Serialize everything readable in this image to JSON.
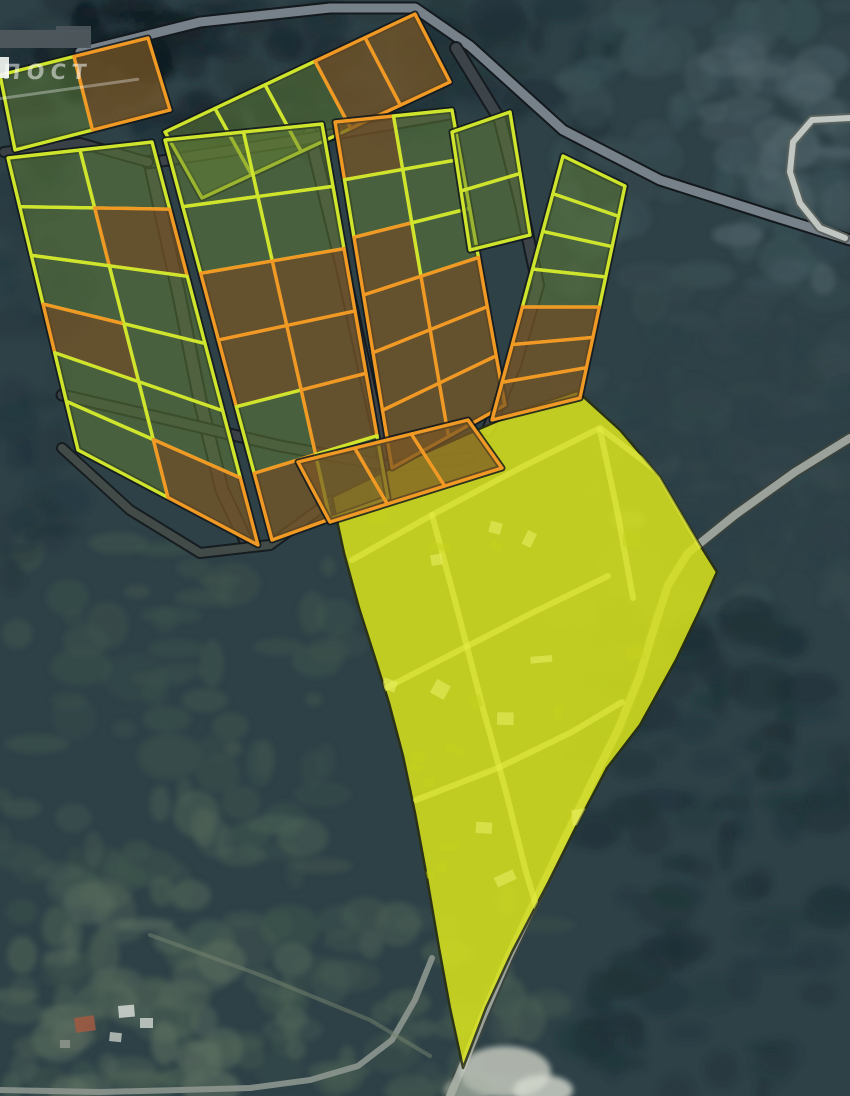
{
  "overlay": {
    "watermark": "ПОСТ"
  },
  "map": {
    "width": 850,
    "height": 1096,
    "colors": {
      "base": "#2e4147",
      "available_stroke": "#cfe42d",
      "sold_stroke": "#f09a25",
      "available_fill": "rgba(100,130,52,0.48)",
      "sold_fill": "rgba(122,88,38,0.72)",
      "block_outline": "#10171b",
      "region_inner_road": "#e7ef49",
      "watermark_color": "rgba(255,255,255,0.52)",
      "gray_bar": "#4e575d"
    },
    "terrain": {
      "zones": [
        {
          "x": 0,
          "y": 0,
          "w": 340,
          "h": 150,
          "color": "#1b2a31",
          "count": 70
        },
        {
          "x": 300,
          "y": 0,
          "w": 330,
          "h": 130,
          "color": "#1f3137",
          "count": 55
        },
        {
          "x": 560,
          "y": 0,
          "w": 290,
          "h": 300,
          "color": "#3a5156",
          "count": 70
        },
        {
          "x": 700,
          "y": 40,
          "w": 150,
          "h": 240,
          "color": "#50646a",
          "count": 30
        },
        {
          "x": 560,
          "y": 280,
          "w": 290,
          "h": 340,
          "color": "#35494d",
          "count": 60
        },
        {
          "x": 580,
          "y": 600,
          "w": 270,
          "h": 496,
          "color": "#1f3238",
          "count": 110
        },
        {
          "x": 0,
          "y": 540,
          "w": 350,
          "h": 556,
          "color": "#3f554d",
          "count": 100
        },
        {
          "x": 0,
          "y": 800,
          "w": 320,
          "h": 296,
          "color": "#4e6356",
          "count": 55
        },
        {
          "x": 20,
          "y": 900,
          "w": 210,
          "h": 196,
          "color": "#5b6e5f",
          "count": 30
        },
        {
          "x": 0,
          "y": 140,
          "w": 70,
          "h": 440,
          "color": "#24373e",
          "count": 40
        },
        {
          "x": 330,
          "y": 880,
          "w": 220,
          "h": 216,
          "color": "#475c52",
          "count": 40
        },
        {
          "x": 60,
          "y": 0,
          "w": 130,
          "h": 80,
          "color": "#101b21",
          "count": 22
        },
        {
          "x": 620,
          "y": 330,
          "w": 230,
          "h": 260,
          "color": "#2c4046",
          "count": 50
        }
      ],
      "clearings": [
        {
          "cx": 505,
          "cy": 1072,
          "rx": 46,
          "ry": 26,
          "color": "#c2c7bc",
          "opacity": 0.85
        },
        {
          "cx": 543,
          "cy": 1090,
          "rx": 30,
          "ry": 15,
          "color": "#d6dacf",
          "opacity": 0.8
        },
        {
          "cx": 468,
          "cy": 1090,
          "rx": 24,
          "ry": 13,
          "color": "#a8b1a5",
          "opacity": 0.7
        },
        {
          "cx": 628,
          "cy": 520,
          "rx": 18,
          "ry": 10,
          "color": "#7e8b85",
          "opacity": 0.4
        }
      ]
    },
    "roads": [
      {
        "name": "main-road-north",
        "points": [
          [
            80,
            52
          ],
          [
            200,
            22
          ],
          [
            330,
            8
          ],
          [
            415,
            8
          ],
          [
            470,
            46
          ],
          [
            563,
            130
          ],
          [
            660,
            180
          ],
          [
            770,
            215
          ],
          [
            850,
            240
          ]
        ],
        "width": 9,
        "color": "#77818a",
        "casing": "#14191d",
        "opacity": 1
      },
      {
        "name": "road-east-loop",
        "points": [
          [
            850,
            118
          ],
          [
            812,
            120
          ],
          [
            793,
            142
          ],
          [
            790,
            172
          ],
          [
            800,
            203
          ],
          [
            820,
            228
          ],
          [
            845,
            238
          ]
        ],
        "width": 6,
        "color": "#c6ccc8",
        "casing": "#5a625e",
        "opacity": 0.95
      },
      {
        "name": "road-region-east",
        "points": [
          [
            850,
            438
          ],
          [
            795,
            472
          ],
          [
            735,
            515
          ],
          [
            688,
            553
          ],
          [
            668,
            585
          ],
          [
            655,
            625
          ],
          [
            640,
            675
          ],
          [
            618,
            730
          ],
          [
            592,
            782
          ],
          [
            565,
            838
          ],
          [
            537,
            897
          ],
          [
            508,
            958
          ],
          [
            482,
            1018
          ],
          [
            462,
            1068
          ],
          [
            450,
            1096
          ]
        ],
        "width": 8,
        "color": "#9ba29c",
        "casing": "#3a433e",
        "opacity": 1
      },
      {
        "name": "road-south-west",
        "points": [
          [
            432,
            958
          ],
          [
            415,
            1000
          ],
          [
            392,
            1040
          ],
          [
            358,
            1066
          ],
          [
            310,
            1080
          ],
          [
            250,
            1088
          ],
          [
            180,
            1090
          ],
          [
            100,
            1092
          ],
          [
            0,
            1090
          ]
        ],
        "width": 6,
        "color": "#8d968f",
        "opacity": 0.9
      },
      {
        "name": "trail-south",
        "points": [
          [
            150,
            935
          ],
          [
            260,
            975
          ],
          [
            370,
            1020
          ],
          [
            430,
            1056
          ]
        ],
        "width": 4,
        "color": "#75836f",
        "opacity": 0.5
      },
      {
        "name": "estate-road-west-vertical",
        "points": [
          [
            150,
            162
          ],
          [
            178,
            290
          ],
          [
            200,
            400
          ],
          [
            222,
            490
          ],
          [
            248,
            545
          ]
        ],
        "width": 11,
        "color": "#3e464c",
        "casing": "#14191d",
        "opacity": 0.95
      },
      {
        "name": "estate-road-mid-vertical",
        "points": [
          [
            310,
            133
          ],
          [
            342,
            265
          ],
          [
            368,
            385
          ],
          [
            385,
            462
          ],
          [
            370,
            510
          ]
        ],
        "width": 11,
        "color": "#3e464c",
        "casing": "#14191d",
        "opacity": 0.95
      },
      {
        "name": "estate-road-east-vertical",
        "points": [
          [
            456,
            48
          ],
          [
            500,
            120
          ],
          [
            520,
            200
          ],
          [
            538,
            285
          ],
          [
            515,
            365
          ],
          [
            488,
            430
          ]
        ],
        "width": 10,
        "color": "#3e464c",
        "casing": "#14191d",
        "opacity": 0.95
      },
      {
        "name": "estate-road-top",
        "points": [
          [
            148,
            163
          ],
          [
            300,
            140
          ],
          [
            450,
            114
          ]
        ],
        "width": 9,
        "color": "#3e464c",
        "casing": "#14191d",
        "opacity": 0.95
      },
      {
        "name": "estate-road-mid-cross",
        "points": [
          [
            62,
            395
          ],
          [
            170,
            420
          ],
          [
            280,
            446
          ],
          [
            390,
            466
          ],
          [
            470,
            458
          ]
        ],
        "width": 9,
        "color": "#3e464c",
        "casing": "#14191d",
        "opacity": 0.9
      },
      {
        "name": "estate-road-south",
        "points": [
          [
            62,
            448
          ],
          [
            130,
            510
          ],
          [
            200,
            553
          ],
          [
            270,
            545
          ],
          [
            332,
            500
          ]
        ],
        "width": 8,
        "color": "#49514e",
        "casing": "#14191d",
        "opacity": 0.9
      },
      {
        "name": "estate-road-west-link",
        "points": [
          [
            4,
            152
          ],
          [
            80,
            143
          ],
          [
            148,
            162
          ]
        ],
        "width": 8,
        "color": "#3e464c",
        "casing": "#14191d",
        "opacity": 0.9
      }
    ],
    "highlight_region": {
      "fill": "#dbe51d",
      "stroke": "#2a300f",
      "opacity": 0.85,
      "points": [
        [
          332,
          497
        ],
        [
          400,
          464
        ],
        [
          470,
          433
        ],
        [
          530,
          407
        ],
        [
          577,
          391
        ],
        [
          620,
          430
        ],
        [
          660,
          477
        ],
        [
          700,
          545
        ],
        [
          717,
          572
        ],
        [
          699,
          612
        ],
        [
          676,
          660
        ],
        [
          640,
          725
        ],
        [
          607,
          768
        ],
        [
          577,
          825
        ],
        [
          548,
          883
        ],
        [
          512,
          952
        ],
        [
          486,
          1008
        ],
        [
          463,
          1068
        ],
        [
          450,
          1008
        ],
        [
          439,
          948
        ],
        [
          427,
          878
        ],
        [
          415,
          813
        ],
        [
          403,
          756
        ],
        [
          389,
          703
        ],
        [
          375,
          658
        ],
        [
          359,
          608
        ],
        [
          344,
          553
        ]
      ],
      "inner_roads": [
        [
          [
            352,
            560
          ],
          [
            432,
            515
          ],
          [
            520,
            468
          ],
          [
            600,
            428
          ],
          [
            658,
            472
          ],
          [
            700,
            545
          ]
        ],
        [
          [
            432,
            515
          ],
          [
            458,
            612
          ],
          [
            482,
            705
          ],
          [
            506,
            792
          ],
          [
            526,
            872
          ],
          [
            546,
            938
          ]
        ],
        [
          [
            600,
            430
          ],
          [
            618,
            515
          ],
          [
            633,
            598
          ]
        ],
        [
          [
            416,
            800
          ],
          [
            498,
            768
          ],
          [
            572,
            732
          ],
          [
            622,
            702
          ]
        ],
        [
          [
            382,
            690
          ],
          [
            452,
            654
          ],
          [
            530,
            614
          ],
          [
            608,
            576
          ]
        ]
      ],
      "speckles": {
        "x": 360,
        "y": 470,
        "w": 270,
        "h": 430,
        "count": 26,
        "dark": "#c6d11b",
        "light": "#edf46c"
      }
    },
    "parcel_blocks": [
      {
        "name": "northwest-pair",
        "quad": [
          [
            0,
            75
          ],
          [
            148,
            38
          ],
          [
            170,
            110
          ],
          [
            15,
            150
          ]
        ],
        "rows": 1,
        "cols": 2,
        "sold_cells": [
          [
            0,
            1
          ]
        ]
      },
      {
        "name": "north-strip",
        "quad": [
          [
            165,
            132
          ],
          [
            415,
            14
          ],
          [
            450,
            82
          ],
          [
            202,
            198
          ]
        ],
        "rows": 1,
        "cols": 5,
        "sold_cells": [
          [
            0,
            3
          ],
          [
            0,
            4
          ]
        ]
      },
      {
        "name": "west-band",
        "quad": [
          [
            8,
            158
          ],
          [
            152,
            142
          ],
          [
            258,
            545
          ],
          [
            78,
            450
          ]
        ],
        "rows": 6,
        "cols": 2,
        "sold_cells": [
          [
            1,
            1
          ],
          [
            3,
            0
          ],
          [
            5,
            1
          ]
        ]
      },
      {
        "name": "central-band",
        "quad": [
          [
            165,
            140
          ],
          [
            322,
            124
          ],
          [
            388,
            498
          ],
          [
            272,
            540
          ]
        ],
        "rows": 6,
        "cols": 2,
        "sold_cells": [
          [
            2,
            0
          ],
          [
            2,
            1
          ],
          [
            3,
            0
          ],
          [
            3,
            1
          ],
          [
            4,
            1
          ],
          [
            5,
            0
          ]
        ]
      },
      {
        "name": "east-band",
        "quad": [
          [
            335,
            122
          ],
          [
            452,
            110
          ],
          [
            505,
            405
          ],
          [
            392,
            468
          ]
        ],
        "rows": 6,
        "cols": 2,
        "sold_cells": [
          [
            0,
            0
          ],
          [
            2,
            0
          ],
          [
            3,
            0
          ],
          [
            3,
            1
          ],
          [
            4,
            0
          ],
          [
            4,
            1
          ],
          [
            5,
            0
          ],
          [
            5,
            1
          ]
        ]
      },
      {
        "name": "v-diamond",
        "quad": [
          [
            452,
            132
          ],
          [
            510,
            112
          ],
          [
            530,
            235
          ],
          [
            470,
            250
          ]
        ],
        "rows": 2,
        "cols": 1,
        "sold_cells": []
      },
      {
        "name": "east-strip",
        "quad": [
          [
            563,
            156
          ],
          [
            625,
            186
          ],
          [
            580,
            398
          ],
          [
            492,
            420
          ]
        ],
        "rows": 7,
        "cols": 1,
        "sold_cells": [
          [
            4,
            0
          ],
          [
            5,
            0
          ],
          [
            6,
            0
          ]
        ]
      },
      {
        "name": "south-strip",
        "quad": [
          [
            298,
            462
          ],
          [
            468,
            420
          ],
          [
            502,
            468
          ],
          [
            330,
            522
          ]
        ],
        "rows": 1,
        "cols": 3,
        "sold_cells": [
          [
            0,
            0
          ],
          [
            0,
            1
          ],
          [
            0,
            2
          ]
        ]
      }
    ],
    "structures": [
      {
        "x": 74,
        "y": 1018,
        "w": 20,
        "h": 15,
        "color": "#9c5a43",
        "rot": -8
      },
      {
        "x": 118,
        "y": 1006,
        "w": 16,
        "h": 12,
        "color": "#ccd2ce",
        "rot": -5
      },
      {
        "x": 140,
        "y": 1018,
        "w": 13,
        "h": 10,
        "color": "#c2c9c4",
        "rot": 0
      },
      {
        "x": 110,
        "y": 1032,
        "w": 12,
        "h": 9,
        "color": "#b6bdb7",
        "rot": 6
      },
      {
        "x": 60,
        "y": 1040,
        "w": 10,
        "h": 8,
        "color": "#8a9288",
        "rot": 0
      }
    ]
  }
}
